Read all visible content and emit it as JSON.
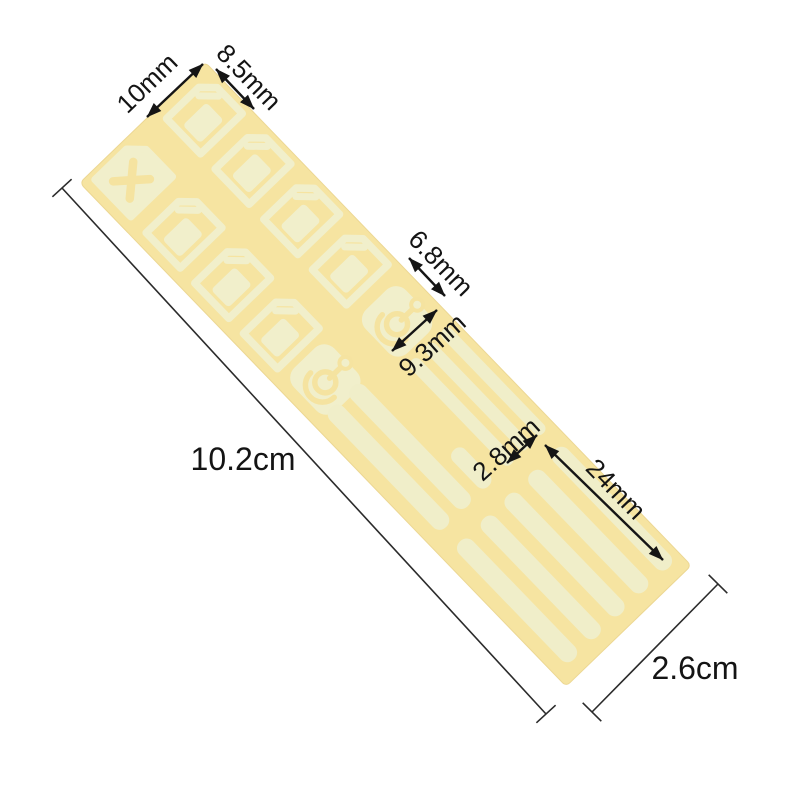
{
  "image": {
    "type": "product dimension photo",
    "background_color": "#ffffff",
    "subject": "Die-cut adhesive sticker sheet shown rotated at an angle with measurement callouts"
  },
  "palette": {
    "sheet_backing": "#f6e4a1",
    "sheet_edge": "#ecd793",
    "sticker_shapes": "#f1efcb",
    "annotation_ink": "#151515"
  },
  "sheet": {
    "rotation_deg": 46,
    "sticker_counts": {
      "sim_card_frames": 7,
      "x_marked_card": 1,
      "padlock_shapes": 2,
      "strips": 11
    }
  },
  "labels": {
    "card_width": "10mm",
    "card_length": "8.5mm",
    "lock_width": "6.8mm",
    "strip_group_width": "9.3mm",
    "strip_width": "2.8mm",
    "strip_length": "24mm",
    "sheet_length": "10.2cm",
    "sheet_width": "2.6cm"
  }
}
